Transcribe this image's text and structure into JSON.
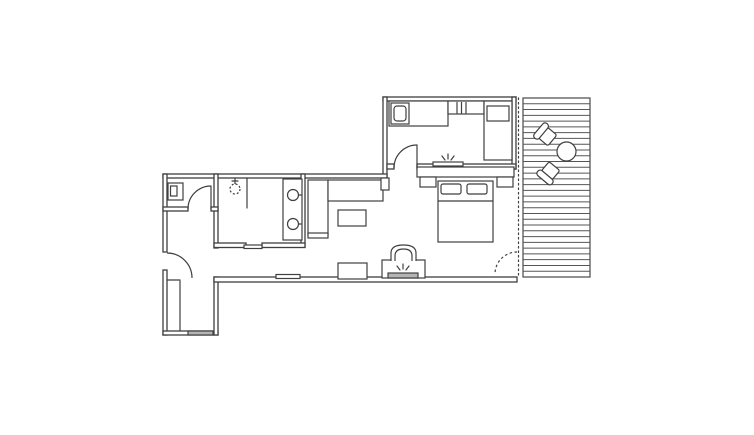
{
  "meta": {
    "title": "studio-apartment-floor-plan-with-deck",
    "type": "floor-plan"
  },
  "canvas": {
    "w": 754,
    "h": 435,
    "bg": "#ffffff"
  },
  "style": {
    "ink": "#3f3f3f",
    "wall_stroke": 1.3,
    "furniture_stroke": 1.2,
    "gray_fill": "#b4b4b4",
    "deck_ink": "#565656",
    "deck_board_stroke": 1.0
  },
  "rooms": [
    "kitchen",
    "bedroom",
    "living-area",
    "bathroom",
    "wc",
    "hallway",
    "entry",
    "deck"
  ],
  "walls": [
    {
      "name": "wall-kitchen-north",
      "x": 383,
      "y": 97,
      "w": 133,
      "h": 4
    },
    {
      "name": "wall-kitchen-west",
      "x": 383,
      "y": 97,
      "w": 4,
      "h": 81
    },
    {
      "name": "wall-kitchen-east",
      "x": 512,
      "y": 97,
      "w": 4,
      "h": 72
    },
    {
      "name": "wall-kitchen-south-stub",
      "x": 387,
      "y": 164,
      "w": 7,
      "h": 5
    },
    {
      "name": "wall-kitchen-south",
      "x": 417,
      "y": 164,
      "w": 99,
      "h": 5
    },
    {
      "name": "wall-main-north",
      "x": 163,
      "y": 174,
      "w": 224,
      "h": 4
    },
    {
      "name": "wall-west-upper",
      "x": 163,
      "y": 174,
      "w": 4,
      "h": 78
    },
    {
      "name": "wall-west-lower",
      "x": 163,
      "y": 270,
      "w": 4,
      "h": 65
    },
    {
      "name": "wall-entry-south",
      "x": 163,
      "y": 331,
      "w": 55,
      "h": 4
    },
    {
      "name": "wall-entry-east",
      "x": 214,
      "y": 277,
      "w": 4,
      "h": 58
    },
    {
      "name": "wall-main-south",
      "x": 214,
      "y": 277,
      "w": 303,
      "h": 5
    },
    {
      "name": "wall-wc-east",
      "x": 214,
      "y": 174,
      "w": 4,
      "h": 74
    },
    {
      "name": "wall-wc-south-west",
      "x": 163,
      "y": 207,
      "w": 25,
      "h": 4
    },
    {
      "name": "wall-wc-south-stub",
      "x": 211,
      "y": 207,
      "w": 7,
      "h": 4
    },
    {
      "name": "wall-bath-east",
      "x": 301,
      "y": 174,
      "w": 4,
      "h": 73
    },
    {
      "name": "wall-bath-south-west",
      "x": 214,
      "y": 243,
      "w": 32,
      "h": 4.5
    },
    {
      "name": "wall-bath-south-east",
      "x": 262,
      "y": 243,
      "w": 43,
      "h": 4.5
    }
  ],
  "furniture_rects": [
    {
      "name": "wc-basin",
      "x": 168,
      "y": 183,
      "w": 15,
      "h": 17
    },
    {
      "name": "wc-basin-bowl",
      "x": 170.5,
      "y": 186,
      "w": 6.5,
      "h": 10
    },
    {
      "name": "bath-vanity-counter",
      "x": 283,
      "y": 179,
      "w": 19,
      "h": 61
    },
    {
      "name": "pocket-door-leaf",
      "x": 244,
      "y": 245,
      "w": 18,
      "h": 3.5
    },
    {
      "name": "sofa-chaise",
      "x": 308,
      "y": 180,
      "w": 20,
      "h": 55
    },
    {
      "name": "sofa-seat",
      "x": 328,
      "y": 180,
      "w": 55,
      "h": 21
    },
    {
      "name": "sofa-end-pad",
      "x": 308,
      "y": 233,
      "w": 20,
      "h": 5
    },
    {
      "name": "wall-column",
      "x": 381,
      "y": 178,
      "w": 8,
      "h": 12
    },
    {
      "name": "coffee-table",
      "x": 338,
      "y": 210,
      "w": 28,
      "h": 16
    },
    {
      "name": "console-shelf",
      "x": 276,
      "y": 274.5,
      "w": 24,
      "h": 4
    },
    {
      "name": "side-table",
      "x": 338,
      "y": 263,
      "w": 29,
      "h": 16
    },
    {
      "name": "fireplace-body",
      "x": 382,
      "y": 260,
      "w": 43,
      "h": 18
    },
    {
      "name": "fireplace-ember-bar",
      "x": 388,
      "y": 273,
      "w": 30,
      "h": 5,
      "fill": "gray"
    },
    {
      "name": "bed-headboard",
      "x": 417,
      "y": 167,
      "w": 97,
      "h": 10
    },
    {
      "name": "headboard-shelf",
      "x": 433,
      "y": 162,
      "w": 30,
      "h": 4
    },
    {
      "name": "nightstand-left",
      "x": 420,
      "y": 177,
      "w": 16,
      "h": 10
    },
    {
      "name": "nightstand-right",
      "x": 497,
      "y": 177,
      "w": 16,
      "h": 10
    },
    {
      "name": "bed",
      "x": 438,
      "y": 181,
      "w": 55,
      "h": 61
    },
    {
      "name": "pillow-left",
      "x": 441,
      "y": 184,
      "w": 20,
      "h": 10,
      "rx": 2
    },
    {
      "name": "pillow-right",
      "x": 467,
      "y": 184,
      "w": 20,
      "h": 10,
      "rx": 2
    },
    {
      "name": "kitchen-counter",
      "x": 389,
      "y": 101,
      "w": 59,
      "h": 25
    },
    {
      "name": "kitchen-sink",
      "x": 391,
      "y": 103,
      "w": 18,
      "h": 21
    },
    {
      "name": "kitchen-sink-basin",
      "x": 394,
      "y": 106,
      "w": 12,
      "h": 15,
      "rx": 3
    },
    {
      "name": "kitchen-upper-rail",
      "x": 448,
      "y": 101,
      "w": 36,
      "h": 13
    },
    {
      "name": "kitchen-tall-unit",
      "x": 484,
      "y": 101,
      "w": 28,
      "h": 59
    },
    {
      "name": "fridge-top",
      "x": 487,
      "y": 106,
      "w": 22,
      "h": 15
    },
    {
      "name": "entry-threshold",
      "x": 188,
      "y": 331,
      "w": 25,
      "h": 4,
      "fill": "gray"
    }
  ],
  "furniture_lines": [
    {
      "name": "entry-closet-line",
      "x1": 180,
      "y1": 281,
      "x2": 180,
      "y2": 331
    },
    {
      "name": "entry-closet-cap",
      "x1": 167,
      "y1": 280,
      "x2": 180,
      "y2": 280
    },
    {
      "name": "bath-partition",
      "x1": 247,
      "y1": 178,
      "x2": 247,
      "y2": 208
    },
    {
      "name": "shower-arm",
      "x1": 235,
      "y1": 178,
      "x2": 235,
      "y2": 184
    },
    {
      "name": "shower-arm-tick",
      "x1": 232,
      "y1": 181,
      "x2": 238,
      "y2": 181
    },
    {
      "name": "sink-tap-1",
      "x1": 296,
      "y1": 195,
      "x2": 301,
      "y2": 195
    },
    {
      "name": "sink-tap-2",
      "x1": 296,
      "y1": 224,
      "x2": 301,
      "y2": 224
    },
    {
      "name": "blanket-line",
      "x1": 438,
      "y1": 201,
      "x2": 493,
      "y2": 201
    },
    {
      "name": "kitchen-rail-tick-1",
      "x1": 457,
      "y1": 102.5,
      "x2": 457,
      "y2": 113
    },
    {
      "name": "kitchen-rail-tick-2",
      "x1": 461.5,
      "y1": 102.5,
      "x2": 461.5,
      "y2": 113
    },
    {
      "name": "kitchen-rail-tick-3",
      "x1": 466,
      "y1": 102.5,
      "x2": 466,
      "y2": 113
    },
    {
      "name": "door-wc-leaf",
      "x1": 211,
      "y1": 186,
      "x2": 211,
      "y2": 209
    },
    {
      "name": "door-kitchen-leaf",
      "x1": 417,
      "y1": 145,
      "x2": 417,
      "y2": 168
    },
    {
      "name": "glass-facade-dotted",
      "x1": 518.5,
      "y1": 98,
      "x2": 518.5,
      "y2": 276,
      "dash": "1.5 3"
    }
  ],
  "furniture_circles": [
    {
      "name": "shower-head",
      "cx": 235,
      "cy": 189,
      "r": 5,
      "dash": "2 2"
    },
    {
      "name": "vanity-sink-1",
      "cx": 293,
      "cy": 195,
      "r": 5.5
    },
    {
      "name": "vanity-sink-2",
      "cx": 293,
      "cy": 224,
      "r": 5.5
    }
  ],
  "furniture_paths": [
    {
      "name": "fireplace-flue-outer",
      "d": "M391,261 L391,253 Q391,245 403.5,245 Q416,245 416,253 L416,261"
    },
    {
      "name": "fireplace-flue-inner",
      "d": "M395,261 L395,256 Q395,249 403.5,249 Q412,249 412,256 L412,261"
    }
  ],
  "doors": [
    {
      "name": "door-entry-arc",
      "d": "M167,253 A25,25 0 0 1 192,278"
    },
    {
      "name": "door-wc-arc",
      "d": "M188,209 A23,23 0 0 1 211,186"
    },
    {
      "name": "door-kitchen-arc",
      "d": "M394,168 A23,23 0 0 1 417,145"
    },
    {
      "name": "door-terrace-arc",
      "d": "M517,252 A22,22 0 0 0 495,274",
      "dash": "2.5 2.5"
    }
  ],
  "sparkles": [
    {
      "name": "flame-fireplace-icon",
      "cx": 403,
      "cy": 271
    },
    {
      "name": "flame-headboard-icon",
      "cx": 448,
      "cy": 161
    }
  ],
  "deck": {
    "name": "deck-terrace",
    "x": 523,
    "y": 98,
    "w": 67,
    "h": 179,
    "board_gaps": 31,
    "table": {
      "name": "deck-round-table",
      "cx": 566.5,
      "cy": 151.5,
      "r": 9.5
    },
    "chairs": [
      {
        "name": "deck-chair-1",
        "x": 547,
        "y": 136,
        "rot": -50
      },
      {
        "name": "deck-chair-2",
        "x": 550,
        "y": 171.5,
        "rot": -140
      }
    ]
  }
}
